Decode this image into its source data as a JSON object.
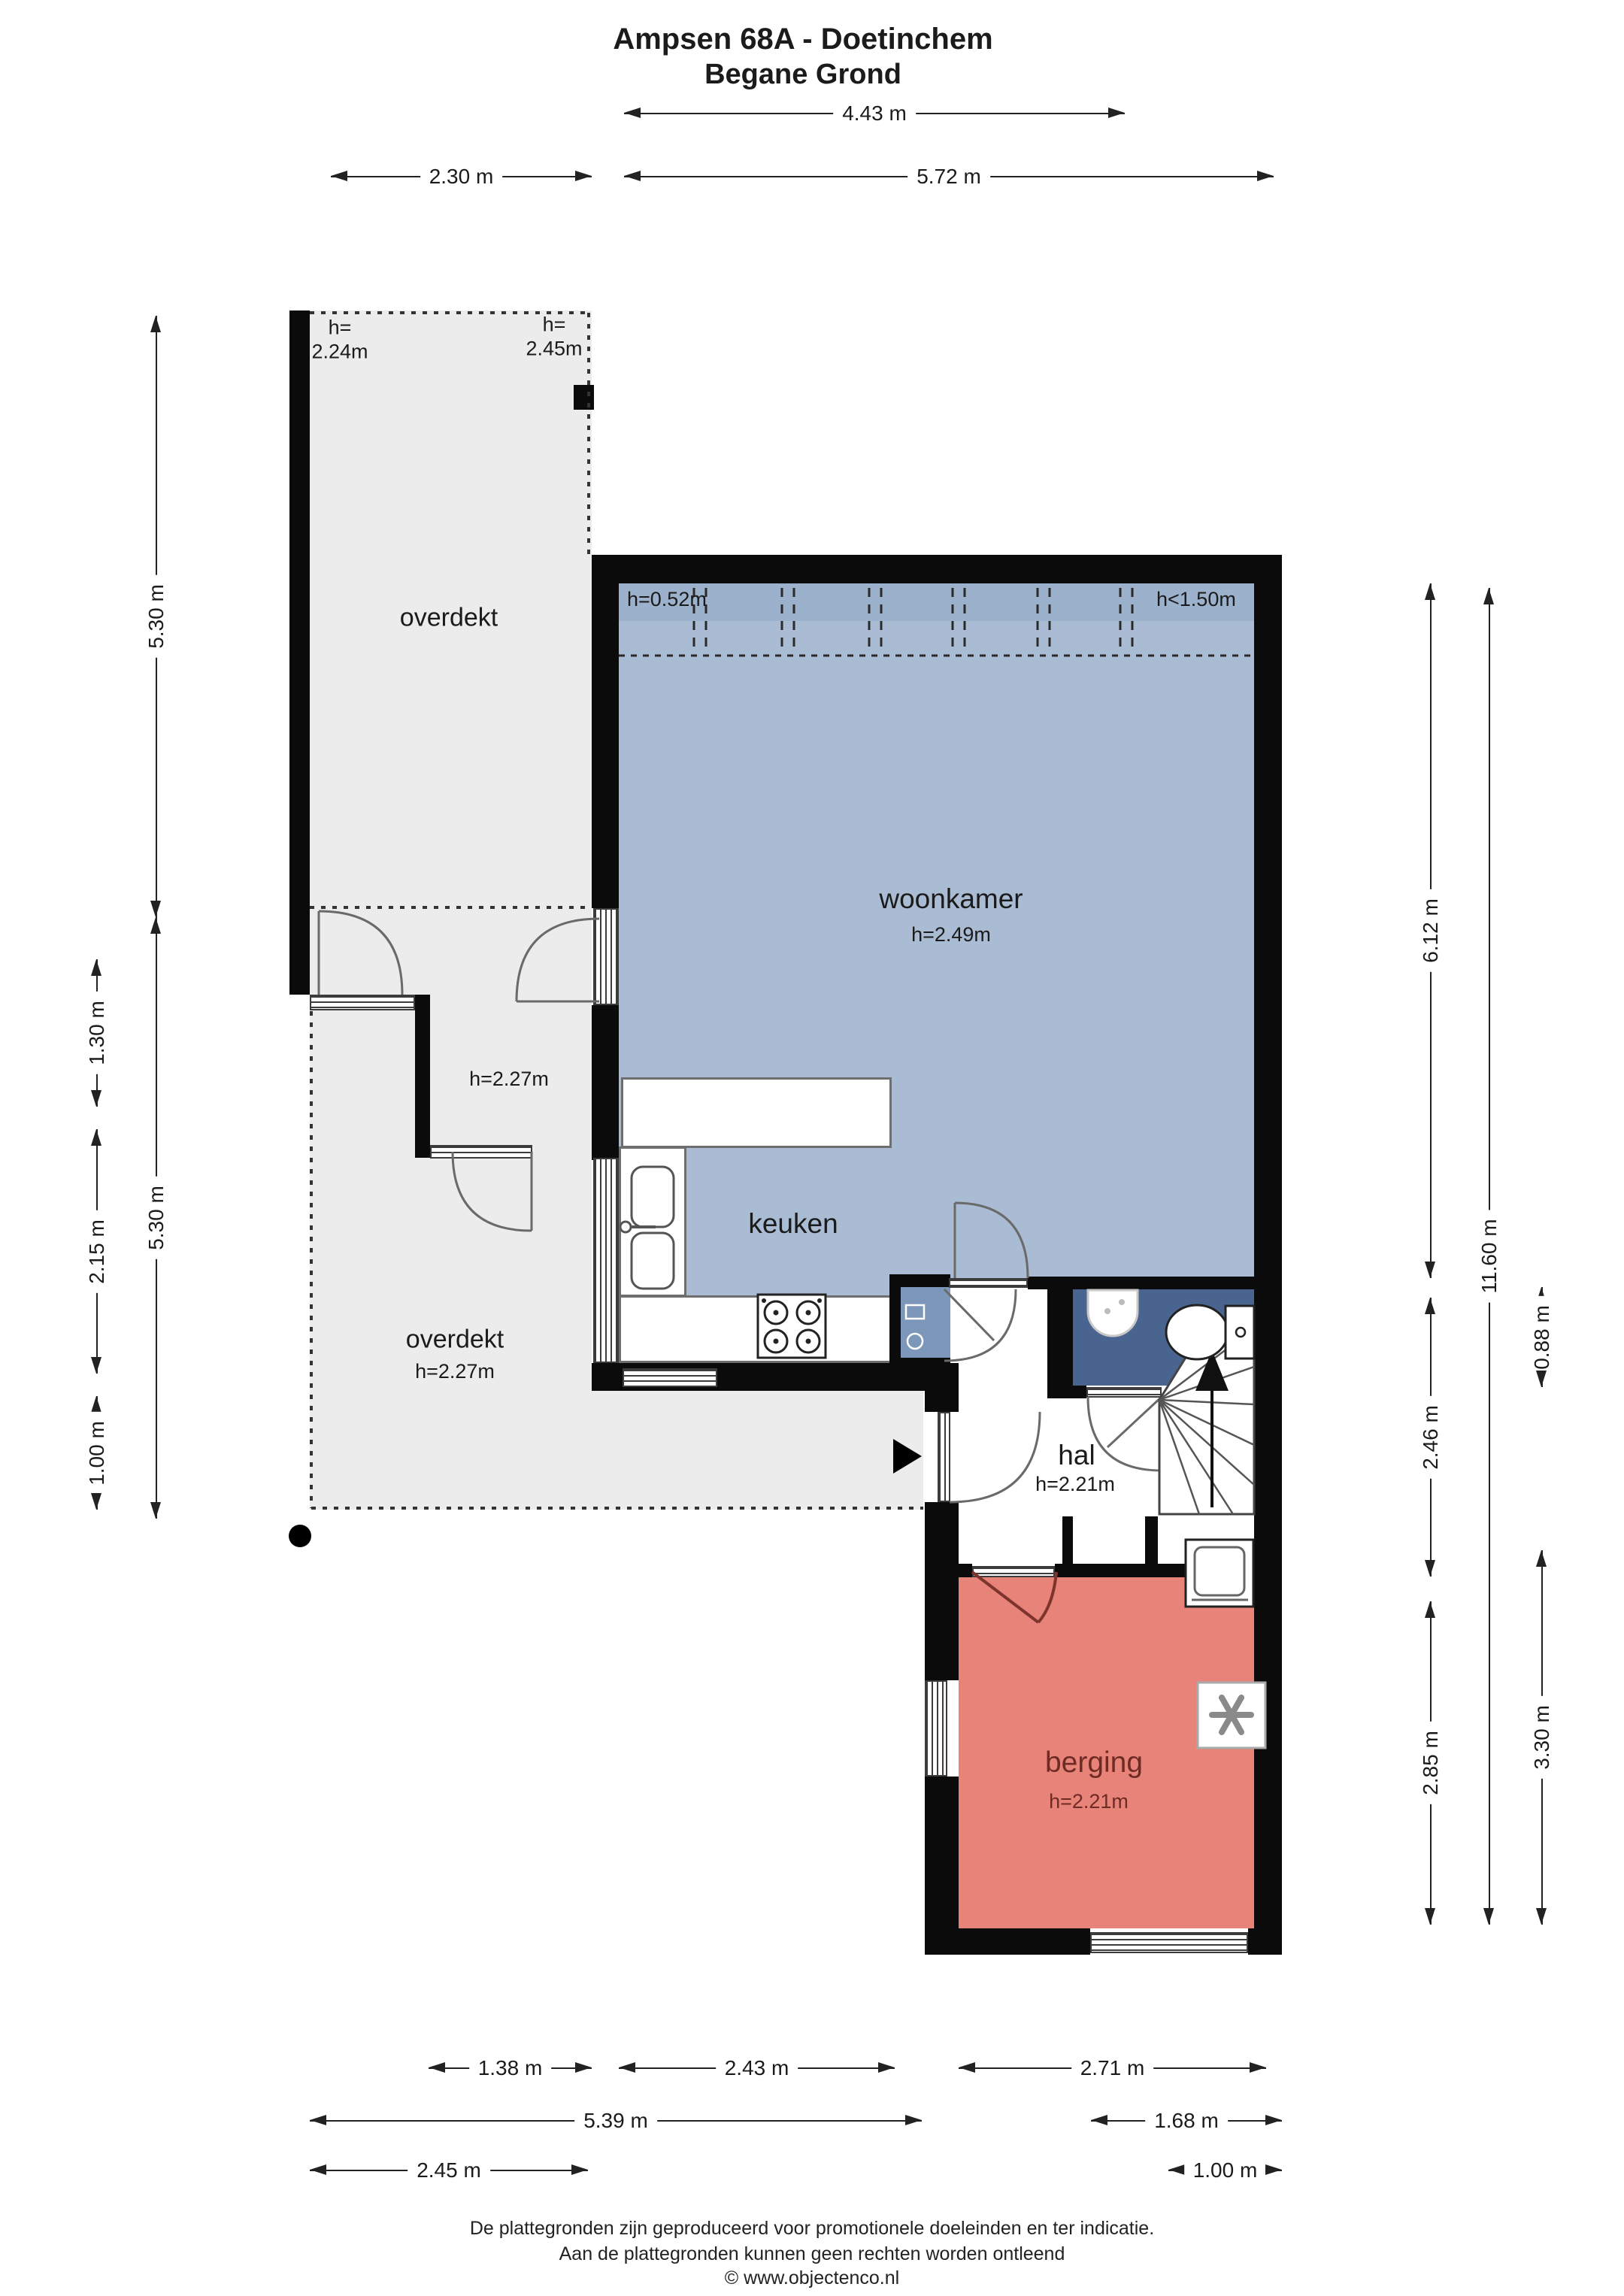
{
  "title": {
    "line1": "Ampsen 68A - Doetinchem",
    "line2": "Begane Grond"
  },
  "rooms": {
    "woonkamer": {
      "name": "woonkamer",
      "height": "h=2.49m"
    },
    "keuken": {
      "name": "keuken"
    },
    "hal": {
      "name": "hal",
      "height": "h=2.21m"
    },
    "berging": {
      "name": "berging",
      "height": "h=2.21m"
    },
    "overdekt_top": {
      "name": "overdekt",
      "height_left": "h=\n2.24m",
      "height_right": "h=\n2.45m"
    },
    "overdekt_bottom": {
      "name": "overdekt",
      "height": "h=2.27m"
    },
    "tussenruimte": {
      "height": "h=2.27m"
    }
  },
  "annotations": {
    "roof_left": "h=0.52m",
    "roof_right": "h<1.50m"
  },
  "dimensions": {
    "top": {
      "d1": "4.43 m",
      "d2": "2.30 m",
      "d3": "5.72 m"
    },
    "bottom": {
      "d1": "1.38 m",
      "d2": "2.43 m",
      "d3": "2.71 m",
      "d4": "5.39 m",
      "d5": "1.68 m",
      "d6": "2.45 m",
      "d7": "1.00 m"
    },
    "left": {
      "d1": "5.30 m",
      "d2": "1.30 m",
      "d3": "2.15 m",
      "d4": "1.00 m",
      "d5": "5.30 m"
    },
    "right": {
      "d1": "6.12 m",
      "d2": "11.60 m",
      "d3": "0.88 m",
      "d4": "2.46 m",
      "d5": "2.85 m",
      "d6": "3.30 m"
    }
  },
  "footer": {
    "line1": "De plattegronden zijn geproduceerd voor promotionele doeleinden en ter indicatie.",
    "line2": "Aan de plattegronden kunnen geen rechten worden ontleend",
    "line3": "© www.objectenco.nl"
  },
  "colors": {
    "room_blue": "#a9bcd3",
    "room_blue_dark": "#9cb1cb",
    "toilet_blue": "#49648e",
    "meterkast_blue": "#7d97ba",
    "berging_red": "#e8837a",
    "berging_text": "#6e2b24",
    "overdekt_gray": "#ececec",
    "wall_black": "#0b0b0b"
  }
}
